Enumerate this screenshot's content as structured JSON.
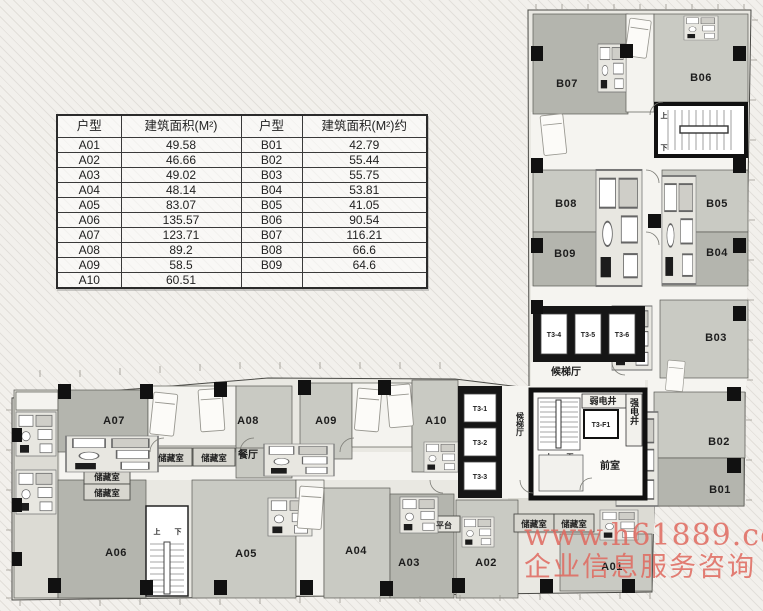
{
  "table": {
    "headers": [
      "户型",
      "建筑面积(M²)",
      "户型",
      "建筑面积(M²)约"
    ],
    "rows": [
      [
        "A01",
        "49.58",
        "B01",
        "42.79"
      ],
      [
        "A02",
        "46.66",
        "B02",
        "55.44"
      ],
      [
        "A03",
        "49.02",
        "B03",
        "55.75"
      ],
      [
        "A04",
        "48.14",
        "B04",
        "53.81"
      ],
      [
        "A05",
        "83.07",
        "B05",
        "41.05"
      ],
      [
        "A06",
        "135.57",
        "B06",
        "90.54"
      ],
      [
        "A07",
        "123.71",
        "B07",
        "116.21"
      ],
      [
        "A08",
        "89.2",
        "B08",
        "66.6"
      ],
      [
        "A09",
        "58.5",
        "B09",
        "64.6"
      ],
      [
        "A10",
        "60.51",
        "",
        ""
      ]
    ]
  },
  "floorplan": {
    "units": {
      "a01": "A01",
      "a02": "A02",
      "a03": "A03",
      "a04": "A04",
      "a05": "A05",
      "a06": "A06",
      "a07": "A07",
      "a08": "A08",
      "a09": "A09",
      "a10": "A10",
      "b01": "B01",
      "b02": "B02",
      "b03": "B03",
      "b04": "B04",
      "b05": "B05",
      "b06": "B06",
      "b07": "B07",
      "b08": "B08",
      "b09": "B09"
    },
    "elevators": {
      "t31": "T3-1",
      "t32": "T3-2",
      "t33": "T3-3",
      "t34": "T3-4",
      "t35": "T3-5",
      "t36": "T3-6",
      "t3f1": "T3-F1"
    },
    "rooms": {
      "lobby": "候梯厅",
      "weak_shaft": "弱电井",
      "strong_shaft": "强电井",
      "front_room": "前室",
      "dining": "餐厅",
      "storage": "储藏室",
      "platform": "平台",
      "up": "上",
      "down": "下"
    }
  },
  "watermark": {
    "line1": "www.h61889.com",
    "line2": "企业信息服务咨询",
    "color": "#e0695f"
  },
  "colors": {
    "wall": "#141414",
    "room_dark": "#b4b5ae",
    "room_mid": "#c9cac3",
    "room_light": "#dcdbd4",
    "corridor_white": "#f5f4f0"
  }
}
